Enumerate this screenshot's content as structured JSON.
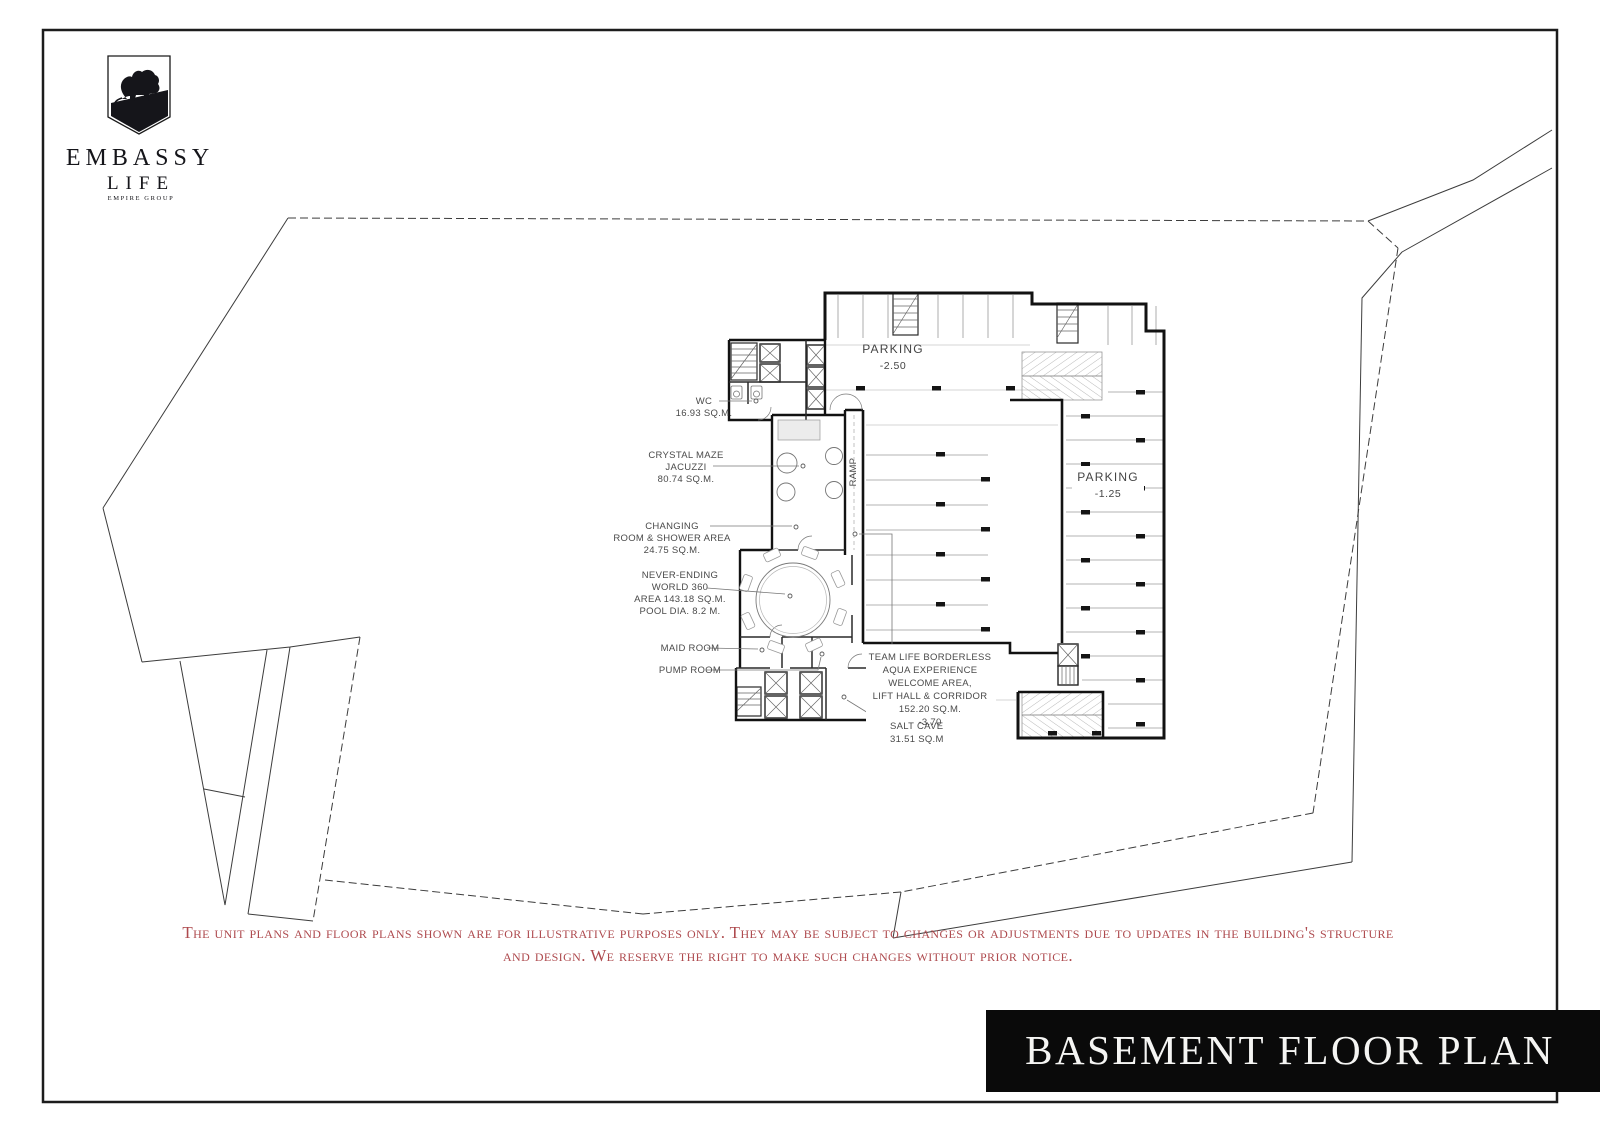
{
  "logo": {
    "brand": "EMBASSY",
    "sub": "LIFE",
    "group": "EMPIRE GROUP"
  },
  "plan": {
    "parking_upper": {
      "name": "PARKING",
      "level": "-2.50"
    },
    "parking_right": {
      "name": "PARKING",
      "level": "-1.25"
    },
    "ramp": "RAMP",
    "labels": {
      "wc": [
        "WC",
        "16.93 SQ.M."
      ],
      "jacuzzi": [
        "CRYSTAL MAZE",
        "JACUZZI",
        "80.74 SQ.M."
      ],
      "changing": [
        "CHANGING",
        "ROOM & SHOWER AREA",
        "24.75 SQ.M."
      ],
      "pool": [
        "NEVER-ENDING",
        "WORLD 360",
        "AREA 143.18 SQ.M.",
        "POOL DIA. 8.2 M."
      ],
      "maid": [
        "MAID ROOM"
      ],
      "pump": [
        "PUMP ROOM"
      ],
      "welcome": [
        "TEAM LIFE BORDERLESS",
        "AQUA EXPERIENCE",
        "WELCOME AREA,",
        "LIFT HALL & CORRIDOR",
        "152.20 SQ.M.",
        "-3.70"
      ],
      "salt": [
        "SALT CAVE",
        "31.51 SQ.M"
      ]
    }
  },
  "disclaimer": {
    "line1": "The unit plans and floor plans shown are for illustrative purposes only. They may be subject to changes or adjustments due to updates in the building's structure",
    "line2": "and design. We reserve the right to make such changes without prior notice."
  },
  "title": {
    "banner": "BASEMENT FLOOR PLAN"
  },
  "colors": {
    "accent_red": "#ae4a4e",
    "ink": "#111111",
    "banner_bg": "#0a0a0a"
  }
}
